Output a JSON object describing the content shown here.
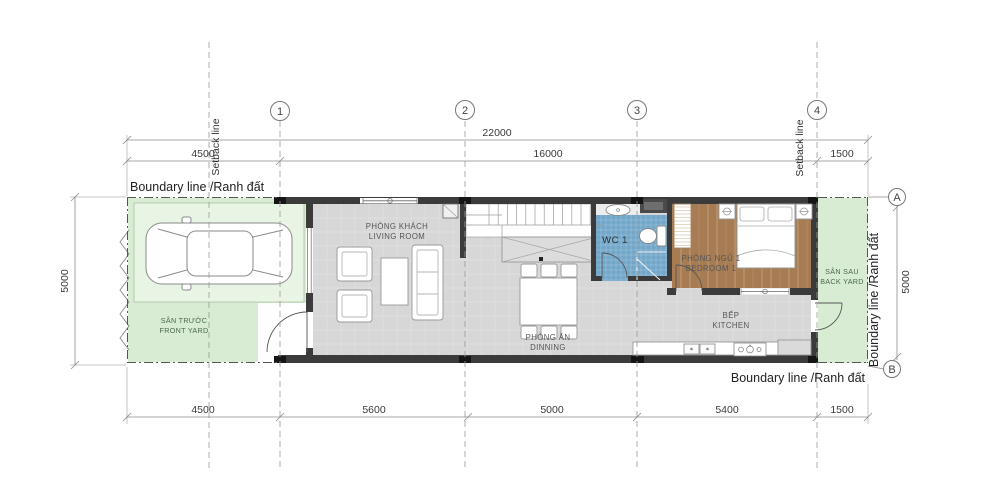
{
  "drawing_type": "floor-plan",
  "grid": {
    "columns": [
      "1",
      "2",
      "3",
      "4"
    ],
    "rows": [
      "A",
      "B"
    ]
  },
  "dimensions": {
    "top_total": "22000",
    "top_segments": [
      "4500",
      "16000",
      "1500"
    ],
    "bottom_segments": [
      "4500",
      "5600",
      "5000",
      "5400",
      "1500"
    ],
    "left_height": "5000",
    "right_height": "5000"
  },
  "labels": {
    "boundary_top": "Boundary line /Ranh đất",
    "boundary_bottom": "Boundary line /Ranh đất",
    "boundary_right": "Boundary line /Ranh đất",
    "setback_left": "Setback line",
    "setback_right": "Setback line"
  },
  "rooms": {
    "living": {
      "vi": "PHÒNG KHÁCH",
      "en": "LIVING ROOM"
    },
    "dining": {
      "vi": "PHÒNG ĂN",
      "en": "DINNING"
    },
    "kitchen": {
      "vi": "BẾP",
      "en": "KITCHEN"
    },
    "bedroom1": {
      "vi": "PHÒNG NGỦ 1",
      "en": "BEDROOM 1"
    },
    "wc1": {
      "label": "WC 1"
    },
    "front_yard": {
      "vi": "SÂN TRƯỚC",
      "en": "FRONT YARD"
    },
    "back_yard": {
      "vi": "SÂN SAU",
      "en": "BACK YARD"
    }
  },
  "colors": {
    "yard_green": "#d8ebd3",
    "pad_green": "#e9f5e4",
    "floor_gray": "#d7d7d7",
    "wc_blue": "#72a7c9",
    "wood_brown": "#a87c52",
    "wall_dark": "#3b3b3b"
  }
}
